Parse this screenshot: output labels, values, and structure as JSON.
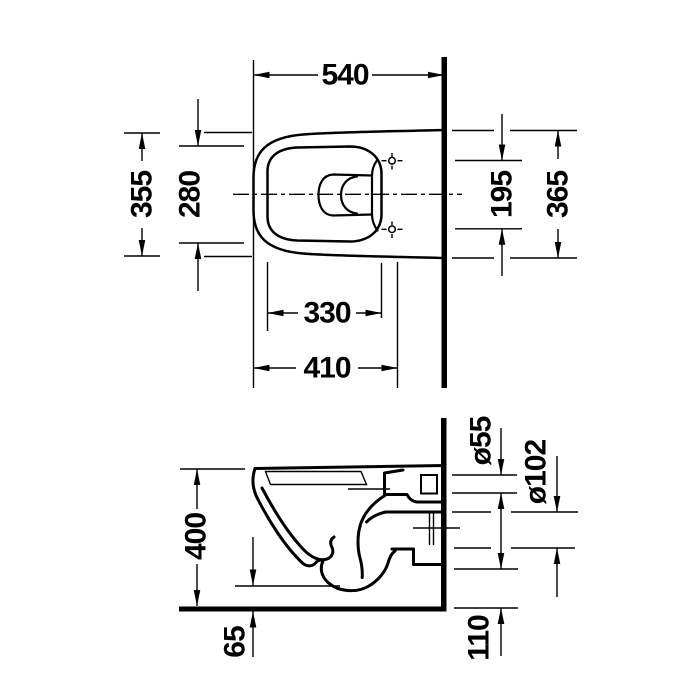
{
  "drawing": {
    "kind": "technical-dimension-drawing",
    "subject": "wall-hung-toilet",
    "background_color": "#ffffff",
    "line_color": "#000000"
  },
  "top_view": {
    "overall_depth": "540",
    "outer_width_front": "355",
    "inner_width": "280",
    "hole_spacing": "195",
    "outer_width_wall": "365",
    "inner_length": "330",
    "front_to_holes": "410"
  },
  "side_view": {
    "height": "400",
    "flush_inlet_diameter": "ø55",
    "outlet_diameter": "ø102",
    "bottom_clearance": "65",
    "outlet_height": "110"
  }
}
